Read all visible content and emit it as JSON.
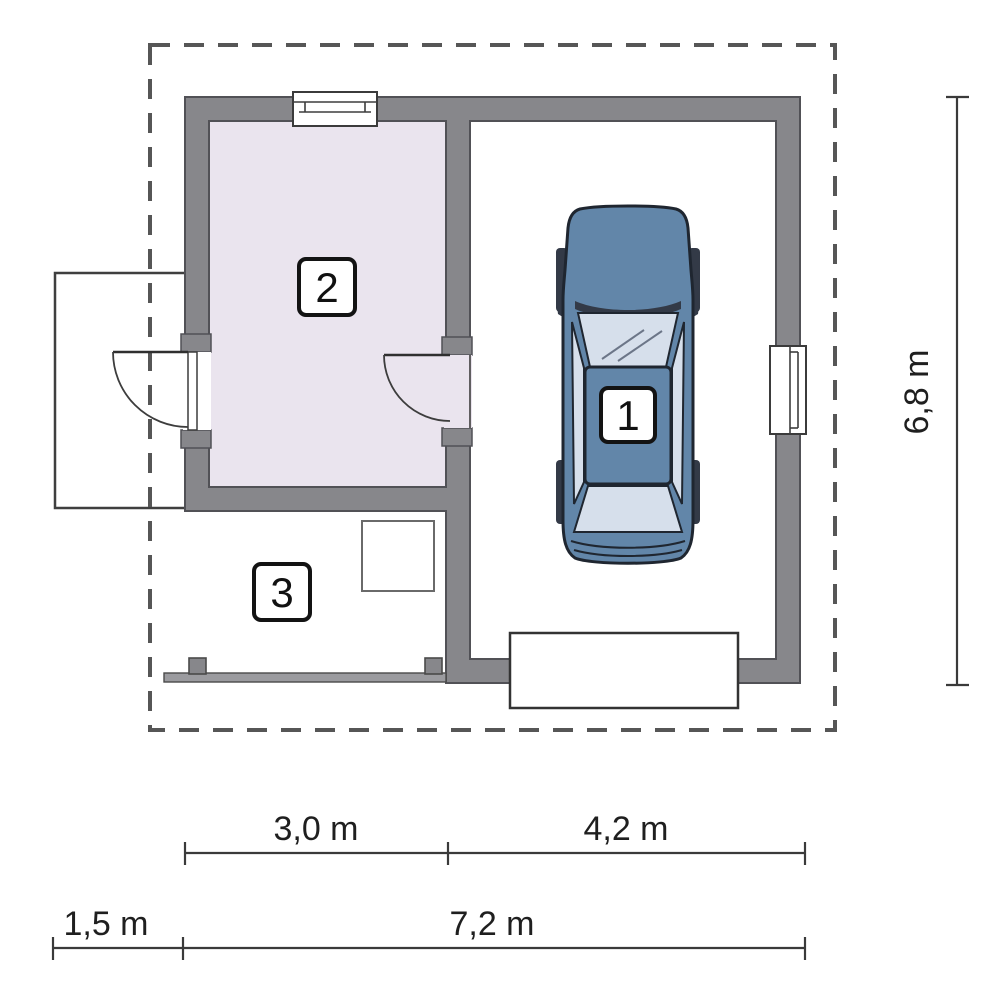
{
  "plan": {
    "rooms": [
      {
        "number": "1",
        "name": "garage"
      },
      {
        "number": "2",
        "name": "storage-room"
      },
      {
        "number": "3",
        "name": "carport"
      }
    ],
    "dimensions": {
      "top_segments": [
        {
          "label": "3,0 m"
        },
        {
          "label": "4,2 m"
        }
      ],
      "bottom_segments": [
        {
          "label": "1,5 m"
        },
        {
          "label": "7,2 m"
        }
      ],
      "right_segment": {
        "label": "6,8 m"
      }
    }
  },
  "colors": {
    "wall": "#87878b",
    "wall_outline": "#515156",
    "room2_floor": "#eae4ee",
    "dashed_line": "#565656",
    "dimension_line": "#3a3a3a",
    "dimension_text": "#1f1f1f",
    "car_body": "#6286a9",
    "car_glass": "#d6dfeb",
    "car_dark": "#333a47",
    "car_outline": "#1f2630",
    "paper": "#ffffff"
  }
}
